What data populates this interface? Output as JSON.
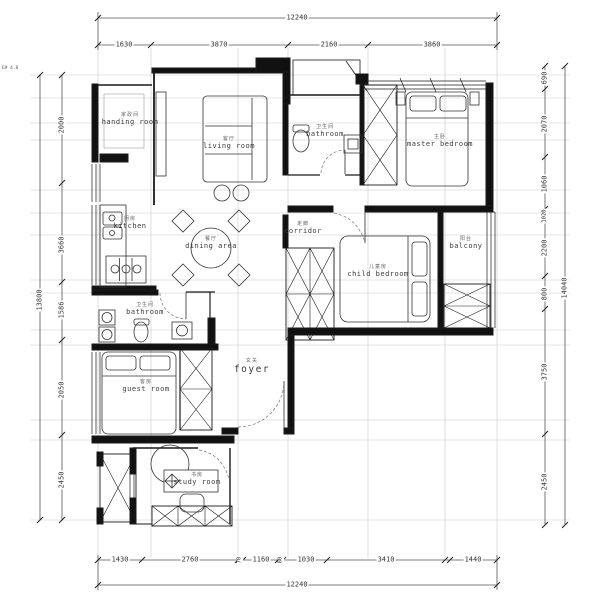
{
  "note": "E# 4.8",
  "dimensions": {
    "top": {
      "total": "12240",
      "segments": [
        "1630",
        "3870",
        "2160",
        "3860"
      ]
    },
    "bottom": {
      "total": "12240",
      "segments": [
        "1430",
        "2760",
        "70",
        "1160",
        "80",
        "1030",
        "3410",
        "1440"
      ]
    },
    "left": {
      "total": "13800",
      "segments": [
        "2000",
        "3660",
        "1586",
        "2050",
        "2450"
      ]
    },
    "right": {
      "total": "14040",
      "segments": [
        "690",
        "2070",
        "1060",
        "1020",
        "2200",
        "800",
        "3750",
        "2450"
      ]
    }
  },
  "rooms": {
    "handing": {
      "cn": "家政间",
      "en": "handing room"
    },
    "living": {
      "cn": "客厅",
      "en": "living room"
    },
    "bathroom1": {
      "cn": "卫生间",
      "en": "bathroom"
    },
    "master": {
      "cn": "主卧",
      "en": "master bedroom"
    },
    "kitchen": {
      "cn": "厨房",
      "en": "kitchen"
    },
    "dining": {
      "cn": "餐厅",
      "en": "dining area"
    },
    "corridor": {
      "cn": "走廊",
      "en": "corridor"
    },
    "child": {
      "cn": "儿童房",
      "en": "child bedroom"
    },
    "balcony": {
      "cn": "阳台",
      "en": "balcony"
    },
    "bathroom2": {
      "cn": "卫生间",
      "en": "bathroom"
    },
    "foyer": {
      "cn": "玄关",
      "en": "foyer"
    },
    "guest": {
      "cn": "客房",
      "en": "guest room"
    },
    "study": {
      "cn": "书房",
      "en": "study room"
    }
  }
}
